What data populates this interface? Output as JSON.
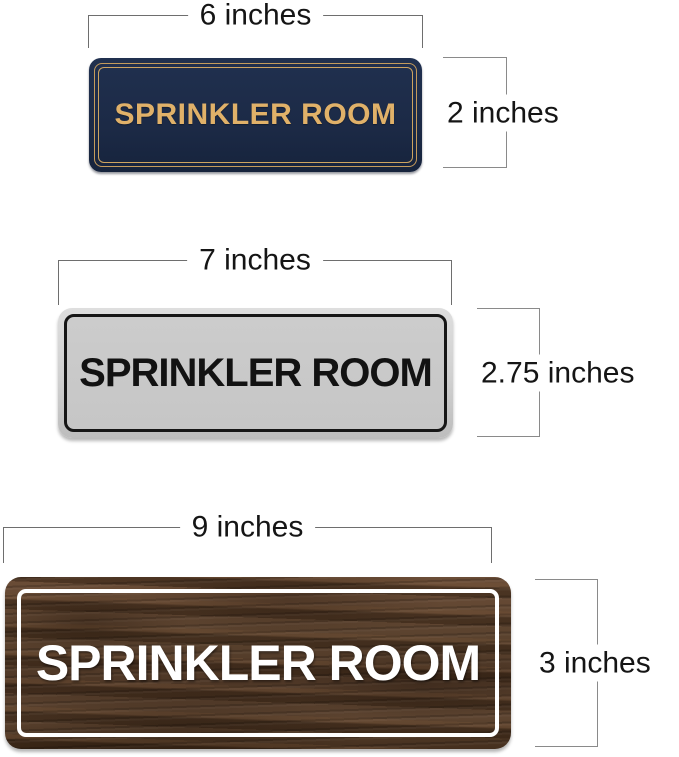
{
  "page": {
    "background_color": "#ffffff",
    "dimension_line_color": "#777777",
    "dimension_text_color": "#151515"
  },
  "signs": [
    {
      "id": "navy-gold-sign",
      "label": "SPRINKLER ROOM",
      "width_label": "6 inches",
      "height_label": "2 inches",
      "bg_color": "#1c2a46",
      "text_color": "#e0b169",
      "border_color": "#cda460"
    },
    {
      "id": "silver-black-sign",
      "label": "SPRINKLER ROOM",
      "width_label": "7 inches",
      "height_label": "2.75 inches",
      "bg_color": "#c9c9c9",
      "text_color": "#121212",
      "border_color": "#161616"
    },
    {
      "id": "walnut-wood-sign",
      "label": "SPRINKLER ROOM",
      "width_label": "9 inches",
      "height_label": "3 inches",
      "bg_color": "#59412e",
      "text_color": "#ffffff",
      "border_color": "#ffffff"
    }
  ]
}
